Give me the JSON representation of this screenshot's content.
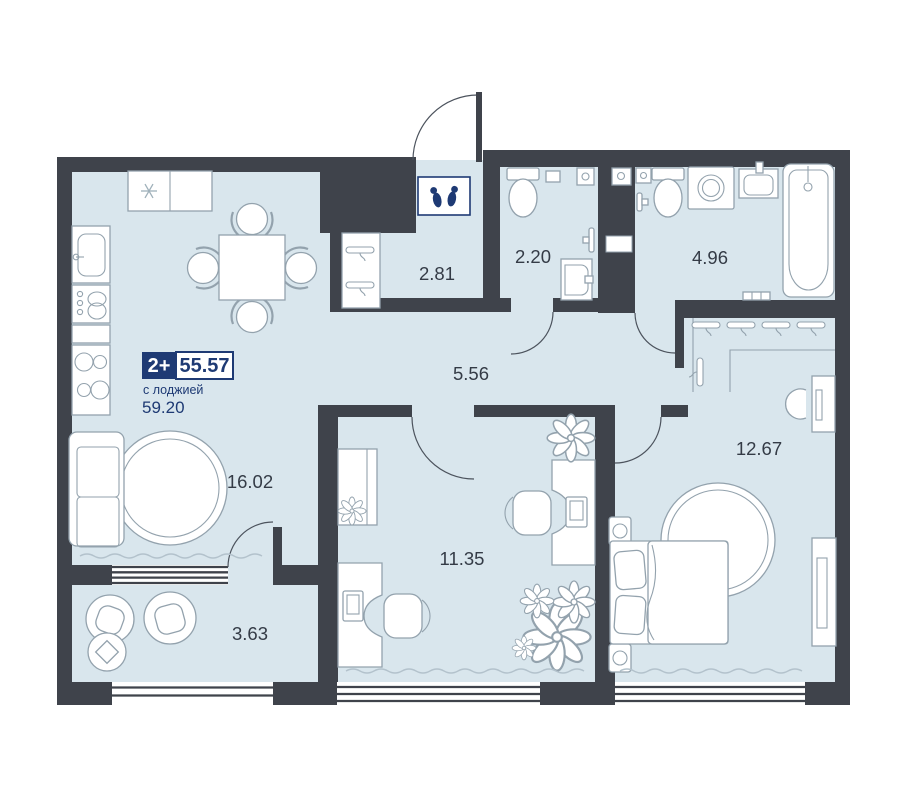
{
  "floorplan": {
    "badge": {
      "rooms_label": "2+",
      "area_main": "55.57",
      "with_loggia_label": "с лоджией",
      "area_with_loggia": "59.20"
    },
    "rooms": [
      {
        "key": "kitchen_living",
        "area": "16.02"
      },
      {
        "key": "office",
        "area": "11.35"
      },
      {
        "key": "bedroom",
        "area": "12.67"
      },
      {
        "key": "corridor",
        "area": "5.56"
      },
      {
        "key": "hallway",
        "area": "2.81"
      },
      {
        "key": "wc",
        "area": "2.20"
      },
      {
        "key": "bathroom",
        "area": "4.96"
      },
      {
        "key": "loggia",
        "area": "3.63"
      }
    ],
    "icons": [
      "slippers-icon",
      "snowflake-icon"
    ],
    "colors": {
      "wall": "#3f434b",
      "floor": "#d9e6ed",
      "accent_navy": "#1e3a74",
      "furniture_stroke": "#93a2ad",
      "label_text": "#343b46",
      "decor_wave": "#b3c2cc"
    }
  }
}
